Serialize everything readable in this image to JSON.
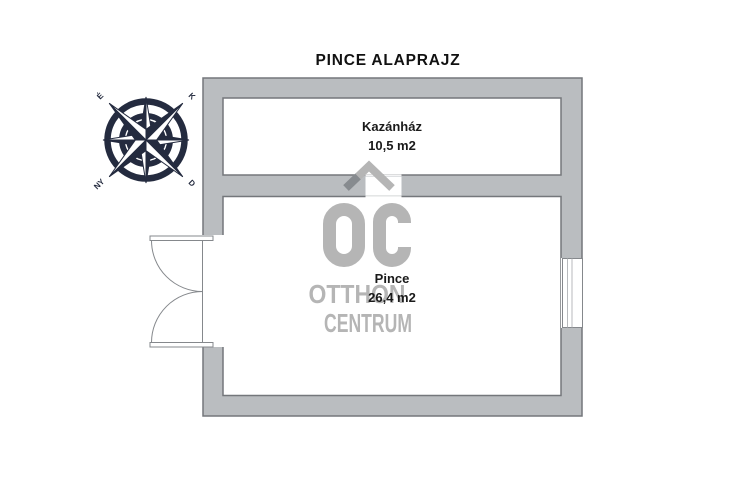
{
  "page": {
    "title": "PINCE ALAPRAJZ"
  },
  "compass": {
    "north": "É",
    "east": "K",
    "west": "NY",
    "south": "D"
  },
  "rooms": {
    "kazanhaz": {
      "name": "Kazánház",
      "area": "10,5 m2"
    },
    "pince": {
      "name": "Pince",
      "area": "26,4 m2"
    }
  },
  "watermark": {
    "initials": "ÓC",
    "line1": "OTTHON",
    "line2": "CENTRUM"
  },
  "colors": {
    "wall_fill": "#babdc0",
    "wall_outline": "#74777b",
    "door_line": "#85888c",
    "watermark_gray": "#b5b5b5",
    "watermark_fold": "#878b8f",
    "compass_navy": "#242b3f",
    "label_black": "#1a1a1a"
  }
}
